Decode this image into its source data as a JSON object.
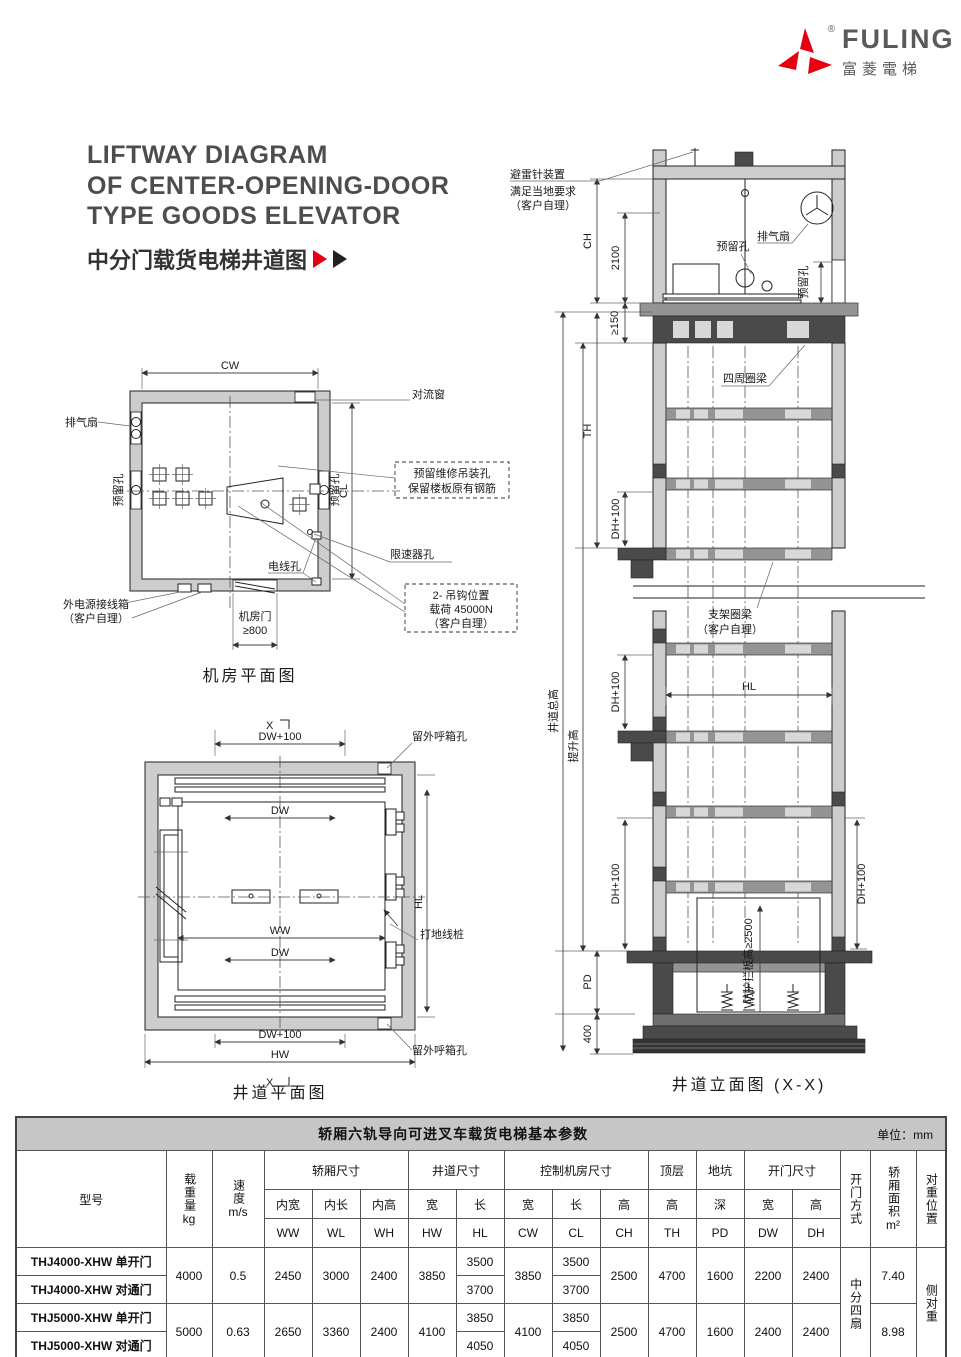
{
  "brand": {
    "name": "FULING",
    "cn": "富菱電梯",
    "reg": "®"
  },
  "title": {
    "en1": "LIFTWAY DIAGRAM",
    "en2": "OF CENTER-OPENING-DOOR",
    "en3": "TYPE GOODS ELEVATOR",
    "cn": "中分门载货电梯井道图"
  },
  "plan_machine_room": {
    "caption": "机房平面图",
    "dim_cw": "CW",
    "dim_cl": "CL",
    "exhaust_fan": "排气扇",
    "reserved_left": "预留孔",
    "reserved_right": "预留孔",
    "convection_window": "对流窗",
    "hoist_note1": "预留维修吊装孔",
    "hoist_note2": "保留楼板原有钢筋",
    "governor_hole": "限速器孔",
    "wire_hole": "电线孔",
    "hook_note1": "2- 吊钩位置",
    "hook_note2": "载荷 45000N",
    "hook_note3": "（客户自理）",
    "power_box1": "外电源接线箱",
    "power_box2": "（客户自理）",
    "door": "机房门",
    "door_dim": "≥800"
  },
  "plan_shaft": {
    "caption": "井道平面图",
    "sec_top": "X",
    "sec_bottom": "X",
    "dim_dw100_top": "DW+100",
    "dim_dw_top": "DW",
    "dim_ww": "WW",
    "dim_dw_bottom": "DW",
    "dim_dw100_bottom": "DW+100",
    "dim_hw": "HW",
    "dim_hl": "HL",
    "callbox_top": "留外呼箱孔",
    "callbox_bottom": "留外呼箱孔",
    "ground_stake": "打地线桩"
  },
  "elevation": {
    "caption": "井道立面图 (X-X)",
    "lightning1": "避雷针装置",
    "lightning2": "满足当地要求",
    "lightning3": "（客户自理）",
    "exhaust_fan": "排气扇",
    "reserved_hole": "预留孔",
    "reserved_hole_r": "预留孔",
    "dim_ch": "CH",
    "dim_2100": "2100",
    "dim_ge150": "≥150",
    "dim_th": "TH",
    "dim_dh100_a": "DH+100",
    "dim_dh100_b": "DH+100",
    "dim_dh100_c": "DH+100",
    "dim_dh100_r": "DH+100",
    "total_height": "井道总高",
    "travel_height": "提升高",
    "dim_pd": "PD",
    "dim_400": "400",
    "dim_hl": "HL",
    "ring_beam": "四周圈梁",
    "bracket_beam1": "支架圈梁",
    "bracket_beam2": "（客户自理）",
    "guard": "防护拦板高≥2500"
  },
  "table": {
    "title": "轿厢六轨导向可进叉车载货电梯基本参数",
    "unit": "单位：mm",
    "h": {
      "model": "型号",
      "load": "载重量",
      "load_u": "kg",
      "speed": "速度",
      "speed_u": "m/s",
      "car": "轿厢尺寸",
      "car_w": "内宽",
      "car_l": "内长",
      "car_h": "内高",
      "ww": "WW",
      "wl": "WL",
      "wh": "WH",
      "shaft": "井道尺寸",
      "shaft_w": "宽",
      "shaft_l": "长",
      "hw": "HW",
      "hl": "HL",
      "room": "控制机房尺寸",
      "room_w": "宽",
      "room_l": "长",
      "room_h": "高",
      "cw": "CW",
      "cl": "CL",
      "ch": "CH",
      "top": "顶层",
      "top_h": "高",
      "th": "TH",
      "pit": "地坑",
      "pit_d": "深",
      "pd": "PD",
      "door": "开门尺寸",
      "door_w": "宽",
      "door_h": "高",
      "dw": "DW",
      "dh": "DH",
      "door_type": "开门方式",
      "area": "轿厢面积",
      "area_u": "m²",
      "cwt": "对重位置"
    },
    "door_type_value": "中分四扇",
    "cwt_value": "侧对重",
    "rows": {
      "m0": "THJ4000-XHW 单开门",
      "m1": "THJ4000-XHW 对通门",
      "m2": "THJ5000-XHW 单开门",
      "m3": "THJ5000-XHW 对通门",
      "g1": {
        "load": "4000",
        "speed": "0.5",
        "ww": "2450",
        "wl": "3000",
        "wh": "2400",
        "hw": "3850",
        "hl0": "3500",
        "hl1": "3700",
        "cw": "3850",
        "cl0": "3500",
        "cl1": "3700",
        "ch": "2500",
        "th": "4700",
        "pd": "1600",
        "dw": "2200",
        "dh": "2400",
        "area": "7.40"
      },
      "g2": {
        "load": "5000",
        "speed": "0.63",
        "ww": "2650",
        "wl": "3360",
        "wh": "2400",
        "hw": "4100",
        "hl0": "3850",
        "hl1": "4050",
        "cw": "4100",
        "cl0": "3850",
        "cl1": "4050",
        "ch": "2500",
        "th": "4700",
        "pd": "1600",
        "dw": "2400",
        "dh": "2400",
        "area": "8.98"
      }
    }
  }
}
